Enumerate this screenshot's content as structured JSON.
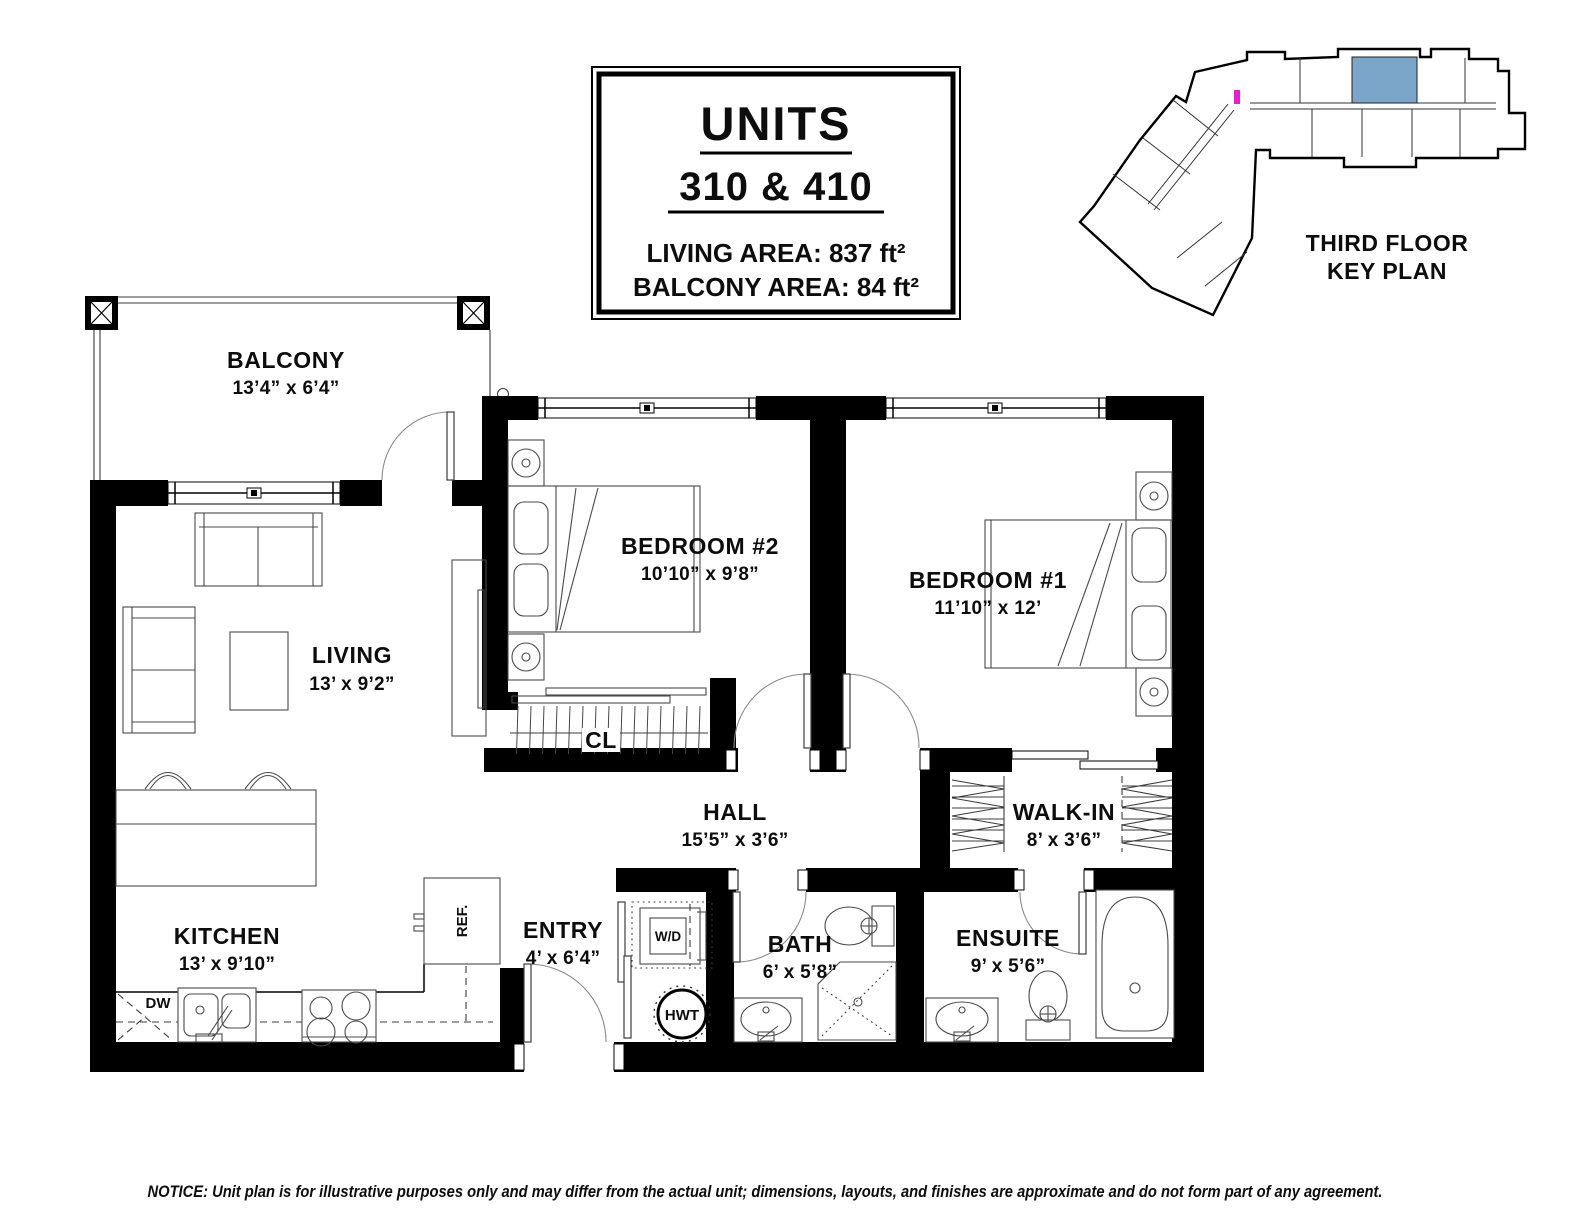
{
  "title_block": {
    "title": "UNITS",
    "subtitle": "310 & 410",
    "living_area": "LIVING AREA: 837 ft²",
    "balcony_area": "BALCONY AREA: 84 ft²"
  },
  "key_plan": {
    "caption_line1": "THIRD FLOOR",
    "caption_line2": "KEY PLAN",
    "highlight_color": "#7ba5c9",
    "marker_color": "#e81cd8"
  },
  "rooms": {
    "balcony": {
      "name": "BALCONY",
      "dims": "13’4” x 6’4”"
    },
    "living": {
      "name": "LIVING",
      "dims": "13’ x 9’2”"
    },
    "bedroom2": {
      "name": "BEDROOM #2",
      "dims": "10’10” x 9’8”"
    },
    "bedroom1": {
      "name": "BEDROOM #1",
      "dims": "11’10” x 12’"
    },
    "closet": {
      "name": "CL"
    },
    "hall": {
      "name": "HALL",
      "dims": "15’5” x 3’6”"
    },
    "walkin": {
      "name": "WALK-IN",
      "dims": "8’ x 3’6”"
    },
    "kitchen": {
      "name": "KITCHEN",
      "dims": "13’ x 9’10”"
    },
    "entry": {
      "name": "ENTRY",
      "dims": "4’ x 6’4”"
    },
    "bath": {
      "name": "BATH",
      "dims": "6’ x 5’8”"
    },
    "ensuite": {
      "name": "ENSUITE",
      "dims": "9’ x 5’6”"
    }
  },
  "fixtures": {
    "washer_dryer": "W/D",
    "hot_water_tank": "HWT",
    "dishwasher": "DW",
    "refrigerator": "REF."
  },
  "notice": "NOTICE: Unit plan is for illustrative purposes only and may differ from the actual unit; dimensions, layouts, and finishes are approximate and do not form part of any agreement."
}
